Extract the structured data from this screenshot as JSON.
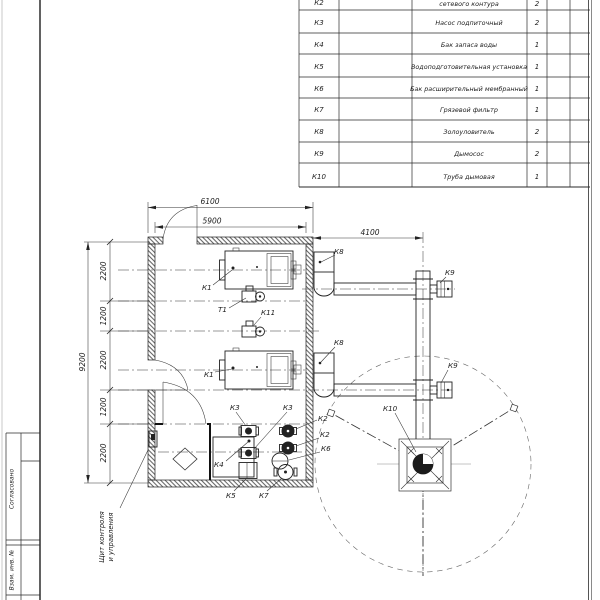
{
  "table": {
    "rows": [
      {
        "pos": "К2",
        "name": "сетевого контура",
        "qty": "2"
      },
      {
        "pos": "К3",
        "name": "Насос подпиточный",
        "qty": "2"
      },
      {
        "pos": "К4",
        "name": "Бак запаса воды",
        "qty": "1"
      },
      {
        "pos": "К5",
        "name": "Водоподготовительная установка",
        "qty": "1"
      },
      {
        "pos": "К6",
        "name": "Бак расширительный мембранный",
        "qty": "1"
      },
      {
        "pos": "К7",
        "name": "Грязевой фильтр",
        "qty": "1"
      },
      {
        "pos": "К8",
        "name": "Золоуловитель",
        "qty": "2"
      },
      {
        "pos": "К9",
        "name": "Дымосос",
        "qty": "2"
      },
      {
        "pos": "К10",
        "name": "Труба дымовая",
        "qty": "1"
      }
    ]
  },
  "dims": {
    "outer_width": "6100",
    "inner_width": "5900",
    "flue_offset": "4100",
    "overall_height": "9200",
    "seg1": "2200",
    "seg2": "1200",
    "seg3": "2200",
    "seg4": "1200",
    "seg5": "2200"
  },
  "labels": {
    "k1_top": "К1",
    "k1_bottom": "К1",
    "t1": "Т1",
    "k11": "К11",
    "k8_top": "К8",
    "k8_bottom": "К8",
    "k9_top": "К9",
    "k9_bottom": "К9",
    "k10": "К10",
    "k3_left": "К3",
    "k3_right": "К3",
    "k2_top": "К2",
    "k2_bottom": "К2",
    "k6": "К6",
    "k4": "К4",
    "k5": "К5",
    "k7": "К7"
  },
  "callout": {
    "line1": "Щит контроля",
    "line2": "и управления"
  },
  "stamp": {
    "approved": "Согласовано",
    "replace_inv": "Взам. инв. №"
  }
}
